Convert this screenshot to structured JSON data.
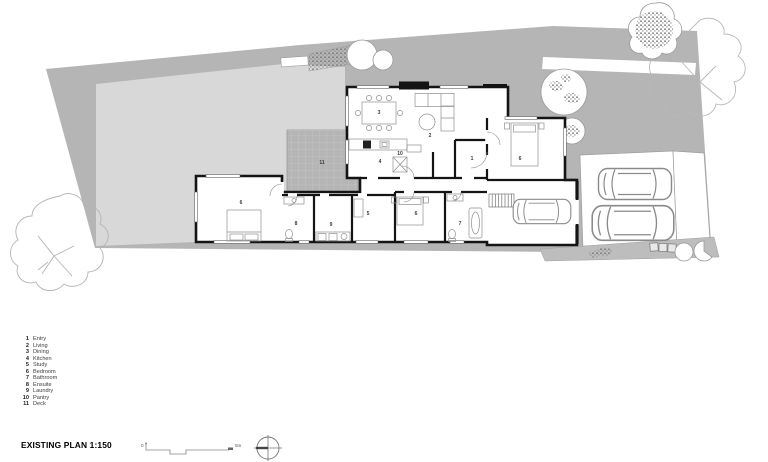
{
  "meta": {
    "title": "EXISTING PLAN 1:150"
  },
  "legend": {
    "items": [
      {
        "num": "1",
        "label": "Entry"
      },
      {
        "num": "2",
        "label": "Living"
      },
      {
        "num": "3",
        "label": "Dining"
      },
      {
        "num": "4",
        "label": "Kitchen"
      },
      {
        "num": "5",
        "label": "Study"
      },
      {
        "num": "6",
        "label": "Bedroom"
      },
      {
        "num": "7",
        "label": "Bathroom"
      },
      {
        "num": "8",
        "label": "Ensuite"
      },
      {
        "num": "9",
        "label": "Laundry"
      },
      {
        "num": "10",
        "label": "Pantry"
      },
      {
        "num": "11",
        "label": "Deck"
      }
    ]
  },
  "plan": {
    "markers": [
      {
        "room": "entry",
        "n": "1"
      },
      {
        "room": "living",
        "n": "2"
      },
      {
        "room": "dining",
        "n": "3"
      },
      {
        "room": "kitchen",
        "n": "4"
      },
      {
        "room": "study",
        "n": "5"
      },
      {
        "room": "bedroom-left",
        "n": "6"
      },
      {
        "room": "bedroom-middle",
        "n": "6"
      },
      {
        "room": "bedroom-top-right",
        "n": "6"
      },
      {
        "room": "bathroom",
        "n": "7"
      },
      {
        "room": "ensuite",
        "n": "8"
      },
      {
        "room": "laundry",
        "n": "9"
      },
      {
        "room": "pantry",
        "n": "10"
      },
      {
        "room": "deck",
        "n": "11"
      }
    ]
  },
  "scalebar": {
    "zero": "0",
    "five": "5m"
  },
  "colors": {
    "site_gray": "#b5b5b5",
    "lawn_gray": "#d8d8d8",
    "strip_gray": "#bdbdbd",
    "wall_black": "#141414"
  }
}
